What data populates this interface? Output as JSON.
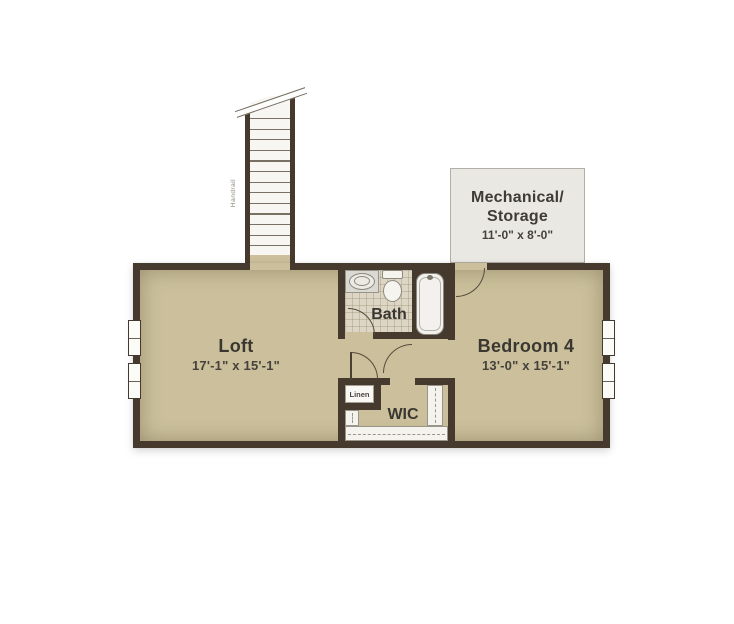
{
  "plan": {
    "rooms": {
      "loft": {
        "name": "Loft",
        "dims": "17'-1\" x 15'-1\""
      },
      "bedroom4": {
        "name": "Bedroom 4",
        "dims": "13'-0\" x 15'-1\""
      },
      "bath": {
        "name": "Bath"
      },
      "wic": {
        "name": "WIC"
      },
      "linen": {
        "name": "Linen"
      },
      "mechanical": {
        "name_line1": "Mechanical/",
        "name_line2": "Storage",
        "dims": "11'-0\" x 8'-0\""
      }
    },
    "stairs": {
      "handrail_label": "Handrail",
      "tread_count": 13
    },
    "colors": {
      "wall": "#463a2e",
      "floor": "#cbc09b",
      "bath_tile": "#ddd6c5",
      "mechanical_fill": "#eae8e3",
      "label_text": "#3a3732",
      "door_arc": "#564b3e"
    }
  }
}
